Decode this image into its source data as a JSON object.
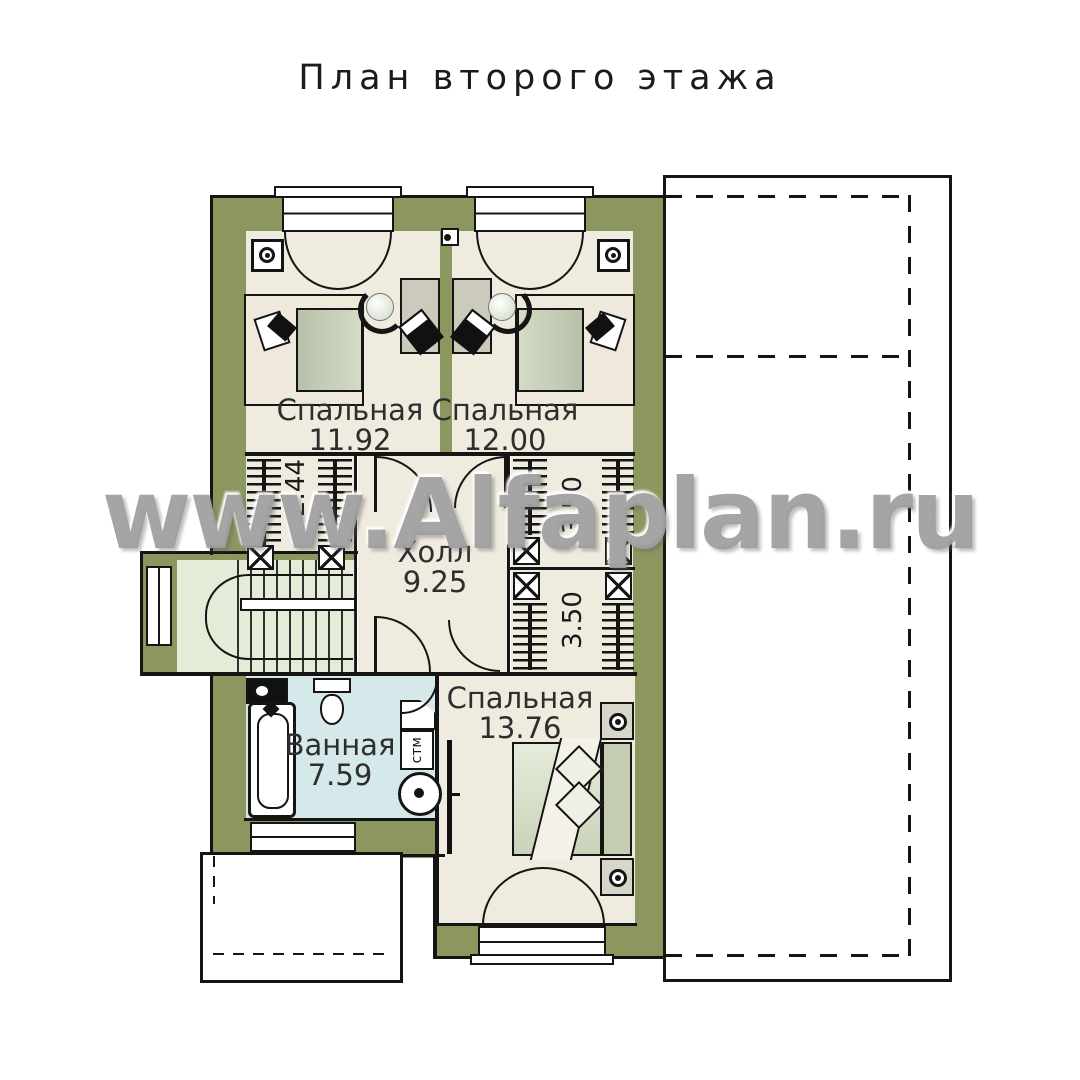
{
  "page": {
    "title": "План второго этажа",
    "watermark": "www.Alfaplan.ru"
  },
  "rooms": [
    {
      "id": "bedroom-1",
      "name": "Спальная",
      "area": "11.92"
    },
    {
      "id": "bedroom-2",
      "name": "Спальная",
      "area": "12.00"
    },
    {
      "id": "hall",
      "name": "Холл",
      "area": "9.25"
    },
    {
      "id": "bathroom",
      "name": "Ванная",
      "area": "7.59"
    },
    {
      "id": "bedroom-3",
      "name": "Спальная",
      "area": "13.76"
    }
  ],
  "dimensions": {
    "closet_left": "2.44",
    "closet_right_top": "3.50",
    "closet_right_bottom": "3.50"
  },
  "appliances": {
    "washing_machine": "стм"
  },
  "colors": {
    "wall_fill": "#8b975f",
    "room_fill": "#f0ebdf",
    "bath_fill": "#d5e9eb",
    "stair_fill": "#e4ebd7",
    "furniture_green": "#c3cdb2",
    "line": "#151515",
    "watermark_grey": "#a3a3a3"
  }
}
